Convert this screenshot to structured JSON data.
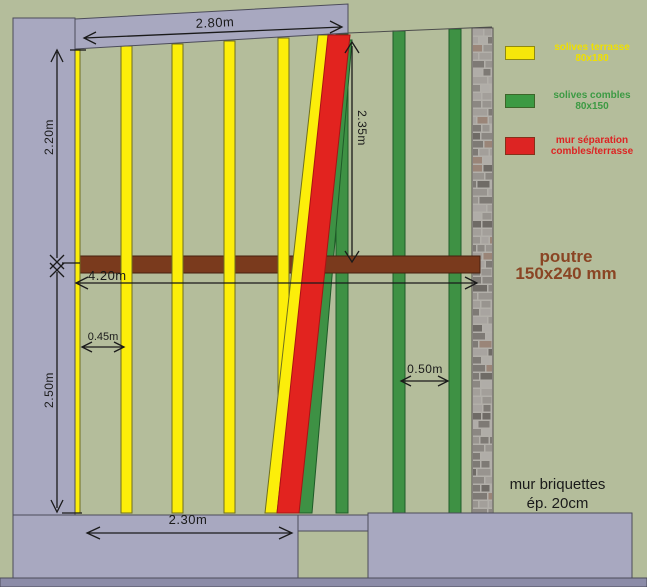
{
  "legend": {
    "items": [
      {
        "name": "solives-terrasse",
        "line1": "solives terrasse",
        "line2": "80x180",
        "swatch_color": "#f6e70a",
        "text_color": "#efe000"
      },
      {
        "name": "solives-combles",
        "line1": "solives combles",
        "line2": "80x150",
        "swatch_color": "#3c9a43",
        "text_color": "#3c9a43"
      },
      {
        "name": "mur-separation",
        "line1": "mur séparation",
        "line2": "combles/terrasse",
        "swatch_color": "#dd2423",
        "text_color": "#dd2423"
      }
    ]
  },
  "dimensions": {
    "top_width": "2.80m",
    "upper_height": "2.20m",
    "separation_height": "2.35m",
    "beam_span": "4.20m",
    "terrace_spacing": "0.45m",
    "combles_spacing": "0.50m",
    "lower_height": "2.50m",
    "bottom_width": "2.30m"
  },
  "labels": {
    "beam_title": "poutre",
    "beam_size": "150x240 mm",
    "beam_color": "#8a4524",
    "brick_wall_title": "mur briquettes",
    "brick_wall_size": "ép. 20cm"
  },
  "colors": {
    "background": "#b4bd9b",
    "wall": "#a8a8c0",
    "terrace_joist": "#fcee0a",
    "combles_joist": "#3e9144",
    "separation_wall": "#e2231f",
    "beam": "#7a3a1d"
  }
}
